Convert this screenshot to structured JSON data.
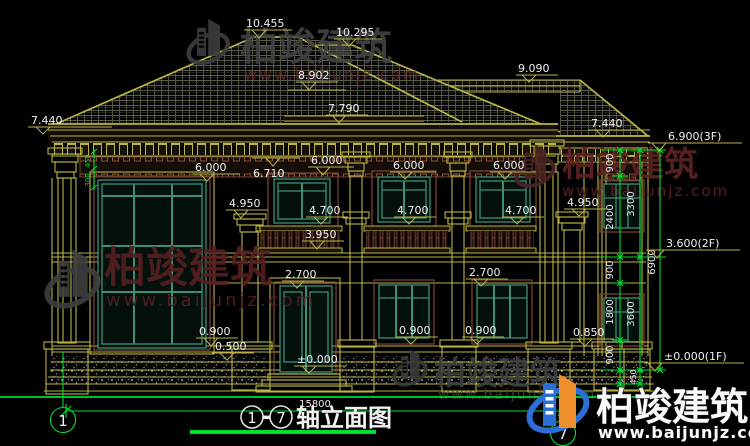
{
  "drawing": {
    "type": "architectural-elevation",
    "title": {
      "start_axis": "1",
      "dash": "-",
      "end_axis": "7",
      "name": "轴立面图"
    },
    "axes": {
      "left": "1",
      "right": "7"
    },
    "elevations": {
      "ridge_main": "10.455",
      "ridge_rear": "10.295",
      "roof_mid": "8.902",
      "roof_low": "7.790",
      "annex_ridge": "9.090",
      "eave_left": "7.440",
      "eave_right": "7.440",
      "floor3": "6.900(3F)",
      "floor2": "3.600(2F)",
      "floor1": "±0.000(1F)",
      "soffit": "6.710",
      "window_head": "6.000",
      "capital": "4.950",
      "window_sill_2f": "4.700",
      "railing_top": "3.950",
      "door_head": "2.700",
      "window_sill_1f": "0.900",
      "plinth_right": "0.850",
      "plinth_left": "0.500",
      "ground": "±0.000"
    },
    "dimensions": {
      "total_width": "15800",
      "total_height": "6900",
      "seg_900": "900",
      "seg_2400": "2400",
      "seg_1800": "1800",
      "seg_450": "450",
      "sub_3300": "3300",
      "sub_3600": "3600",
      "eave_seg_a": "450",
      "eave_seg_b": "300"
    }
  },
  "watermark": {
    "brand": "柏竣建筑",
    "url": "www.baijunjz.com"
  },
  "colors": {
    "background": "#000000",
    "cad_yellow": "#b9b445",
    "cad_green": "#00dd2e",
    "window_teal": "#3f8f77",
    "trim_brown": "#744233",
    "text_white": "#f0f0f0",
    "watermark_red": "#5e2323",
    "watermark_gray": "#404040",
    "logo_blue": "#2a6fd6",
    "logo_orange": "#ef8f2b"
  }
}
